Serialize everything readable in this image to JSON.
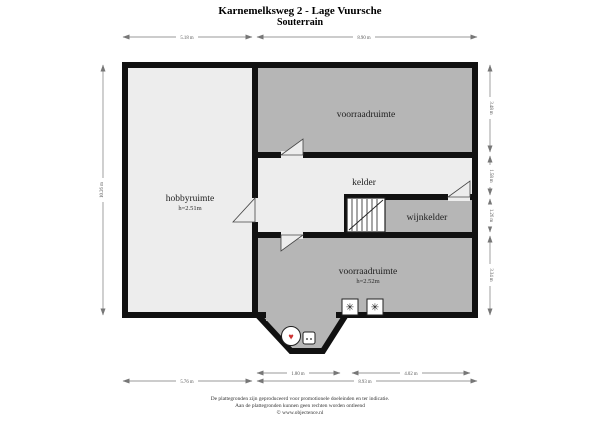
{
  "title": {
    "line1": "Karnemelksweg 2 - Lage Vuursche",
    "line2": "Souterrain"
  },
  "rooms": {
    "hobbyruimte": {
      "label": "hobbyruimte",
      "height": "h=2.51m"
    },
    "voorraad_top": {
      "label": "voorraadruimte"
    },
    "kelder": {
      "label": "kelder"
    },
    "wijnkelder": {
      "label": "wijnkelder"
    },
    "voorraad_bottom": {
      "label": "voorraadruimte",
      "height": "h=2.52m"
    }
  },
  "dimensions": {
    "top": [
      {
        "label": "5.18 m"
      },
      {
        "label": "8.90 m"
      }
    ],
    "left": [
      {
        "label": "10.26 m"
      }
    ],
    "right": [
      {
        "label": "3.48 m"
      },
      {
        "label": "1.58 m"
      },
      {
        "label": "1.26 m"
      },
      {
        "label": "3.34 m"
      }
    ],
    "bottom_inner": [
      {
        "label": "1.80 m"
      },
      {
        "label": "4.02 m"
      }
    ],
    "bottom_outer": [
      {
        "label": "5.76 m"
      },
      {
        "label": "8.93 m"
      }
    ]
  },
  "icons": {
    "appliance_glyph": "✳",
    "heart_glyph": "♥"
  },
  "footer": {
    "line1": "De plattegronden zijn geproduceerd voor promotionele doeleinden en ter indicatie.",
    "line2": "Aan de plattegronden kunnen geen rechten worden ontleend",
    "line3": "© www.objectence.nl"
  },
  "colors": {
    "wall": "#111111",
    "room_light": "#ededed",
    "room_dark": "#b6b6b6",
    "dim": "#777777",
    "heart": "#cc3333"
  }
}
